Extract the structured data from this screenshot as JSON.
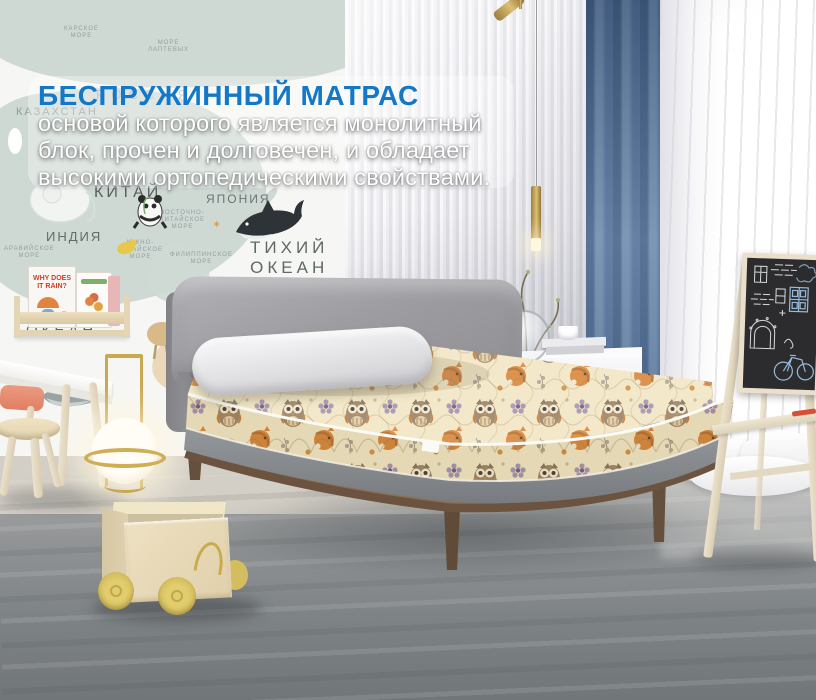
{
  "overlay": {
    "title": "БЕСПРУЖИННЫЙ МАТРАС",
    "line1": "основой которого является монолитный",
    "line2": "блок, прочен и долговечен, и обладает",
    "line3": "высокими ортопедическими свойствами."
  },
  "map_wall": {
    "labels": {
      "kara_sea": "КАРСКОЕ\nМОРЕ",
      "laptev_sea": "МОРЕ\nЛАПТЕВЫХ",
      "russia": "РОССИЯ",
      "kazakhstan": "КАЗАХСТАН",
      "china": "КИТАЙ",
      "japan": "ЯПОНИЯ",
      "india": "ИНДИЯ",
      "arabian_sea": "АРАВИЙСКОЕ\nМОРЕ",
      "east_china_sea": "ВОСТОЧНО-\nКИТАЙСКОЕ\nМОРЕ",
      "south_china_sea": "ЮЖНО-\nКИТАЙСКОЕ\nМОРЕ",
      "philippine_sea": "ФИЛИППИНСКОЕ\nМОРЕ",
      "pacific_ocean": "ТИХИЙ\nОКЕАН",
      "indian_ocean": "ОКЕАН",
      "australia": "АВС"
    }
  },
  "bookshelf": {
    "book_title": "WHY DOES\nIT RAIN?"
  },
  "palette": {
    "title_blue": "#1478c8",
    "curtain_blue": "#5d7da0",
    "mattress_cream": "#f2e6c3",
    "pattern_orange": "#d0863a",
    "frame_walnut": "#6b5440",
    "floor_gray": "#83888a",
    "easel_cream": "#e9dfca",
    "cart_plywood": "#e7dabb",
    "wheel_yellow": "#d9c463"
  }
}
